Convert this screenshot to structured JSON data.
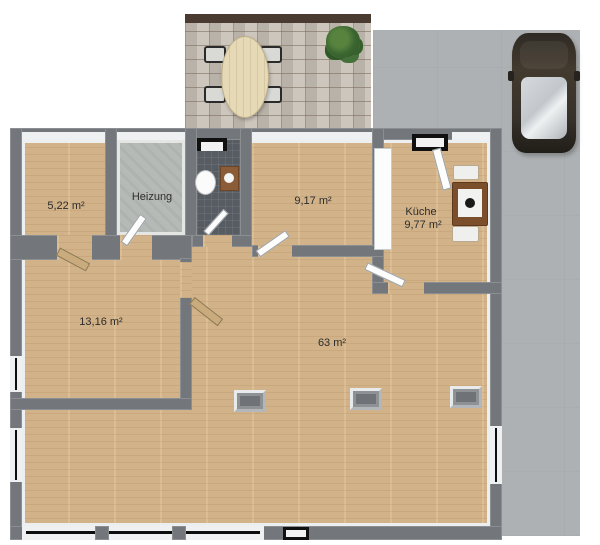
{
  "plan_title": "floor-plan",
  "rooms": {
    "room_522": {
      "label": "5,22 m²"
    },
    "heizung": {
      "label": "Heizung"
    },
    "room_917": {
      "label": "9,17 m²"
    },
    "kueche": {
      "label": "Küche",
      "area": "9,77 m²"
    },
    "room_1316": {
      "label": "13,16 m²"
    },
    "room_63": {
      "label": "63 m²"
    }
  },
  "colors": {
    "wood_floor": "#d9b88c",
    "wall_gray": "#73777b",
    "driveway_gray": "#aeb1b3",
    "terrace_paving": "#c6bfb5",
    "wc_tile": "#575c63",
    "heizung_concrete": "#b6bab6",
    "car_body": "#37322b",
    "window_glazing": "#0d0d0d",
    "label_text": "#2d2d2d"
  }
}
